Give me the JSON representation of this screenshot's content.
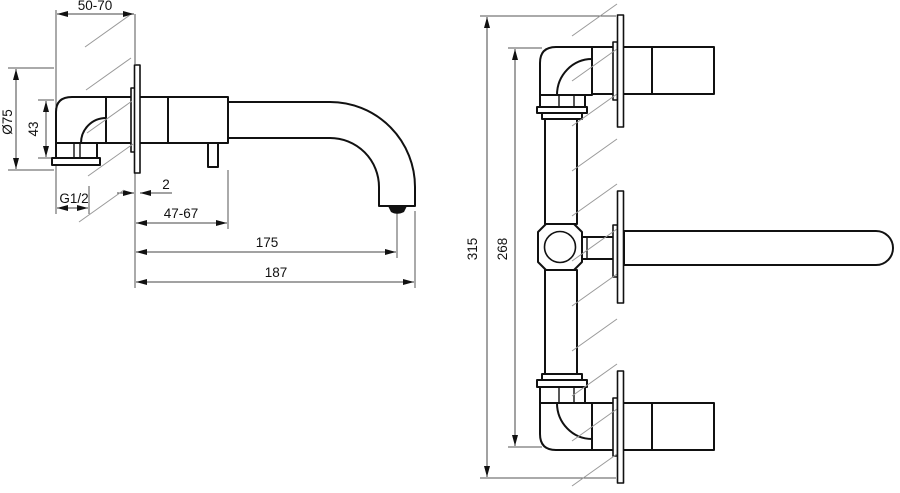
{
  "drawing": {
    "colors": {
      "line": "#111111",
      "dimension_line": "#444444",
      "hatch": "#999999",
      "background": "#ffffff"
    },
    "side_view": {
      "dims": {
        "wall_mount_depth": "50-70",
        "escutcheon_diameter": "Ø75",
        "elbow_height": "43",
        "thread_size": "G1/2",
        "plate_offset": "2",
        "cartridge_projection": "47-67",
        "spout_reach": "175",
        "total_projection": "187"
      }
    },
    "front_view": {
      "dims": {
        "total_height": "315",
        "connection_height": "268"
      }
    }
  }
}
